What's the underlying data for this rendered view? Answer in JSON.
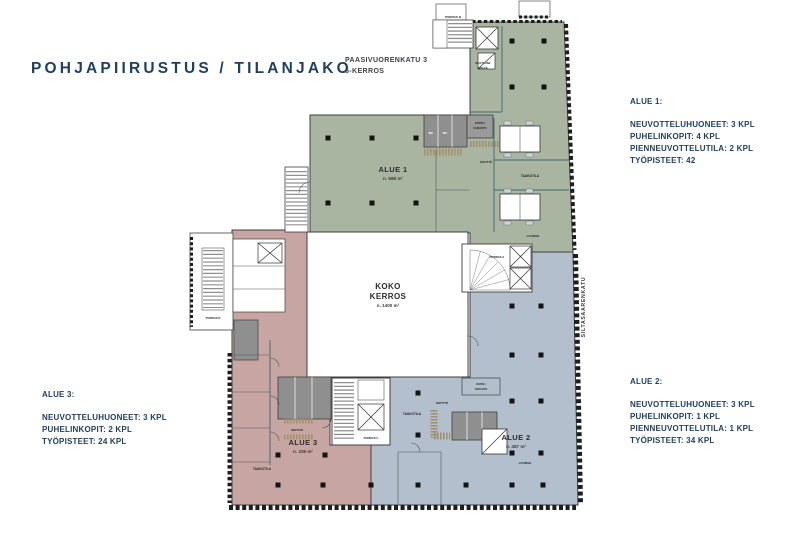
{
  "title": "POHJAPIIRUSTUS / TILANJAKO",
  "address": {
    "line1": "PAASIVUORENKATU 3",
    "line2": "6-KERROS"
  },
  "street_label": "SILTASAARENKATU",
  "stats": {
    "alue1": {
      "heading": "ALUE 1:",
      "lines": [
        "NEUVOTTELUHUONEET: 3 KPL",
        "PUHELINKOPIT: 4 KPL",
        "PIENNEUVOTTELUTILA: 2 KPL",
        "TYÖPISTEET: 42"
      ]
    },
    "alue2": {
      "heading": "ALUE 2:",
      "lines": [
        "NEUVOTTELUHUONEET: 3 KPL",
        "PUHELINKOPIT: 1 KPL",
        "PIENNEUVOTTELUTILA: 1 KPL",
        "TYÖPISTEET: 34 KPL"
      ]
    },
    "alue3": {
      "heading": "ALUE 3:",
      "lines": [
        "NEUVOTTELUHUONEET: 3 KPL",
        "PUHELINKOPIT: 2 KPL",
        "TYÖPISTEET: 24 KPL"
      ]
    }
  },
  "plan": {
    "colors": {
      "alue1": "#a9b5a0",
      "alue2": "#b3bfcd",
      "alue3": "#c7a5a2",
      "accent_navy": "#1e3e5f"
    },
    "areas": {
      "alue1": {
        "name": "ALUE 1",
        "size": "n. 588 m²"
      },
      "alue2": {
        "name": "ALUE 2",
        "size": "n. 487 m²"
      },
      "alue3": {
        "name": "ALUE 3",
        "size": "n. 339 m²"
      },
      "koko_kerros": {
        "line1": "KOKO",
        "line2": "KERROS",
        "size": "n. 1400 m²"
      }
    },
    "rooms": {
      "porras_a": "PORRAS A",
      "porras_b": "PORRAS B",
      "porras_c": "PORRAS C",
      "porras_d": "PORRAS D",
      "wc": "WC",
      "kopio_line1": "KOPIO /",
      "kopio_line2": "VARASTO",
      "keittio": "KEITTIÖ",
      "taukotila": "TAUKOTILA",
      "lounge": "LOUNGE",
      "multiuse_line1": "MULTI-USE",
      "multiuse_line2": "SPACE"
    }
  }
}
